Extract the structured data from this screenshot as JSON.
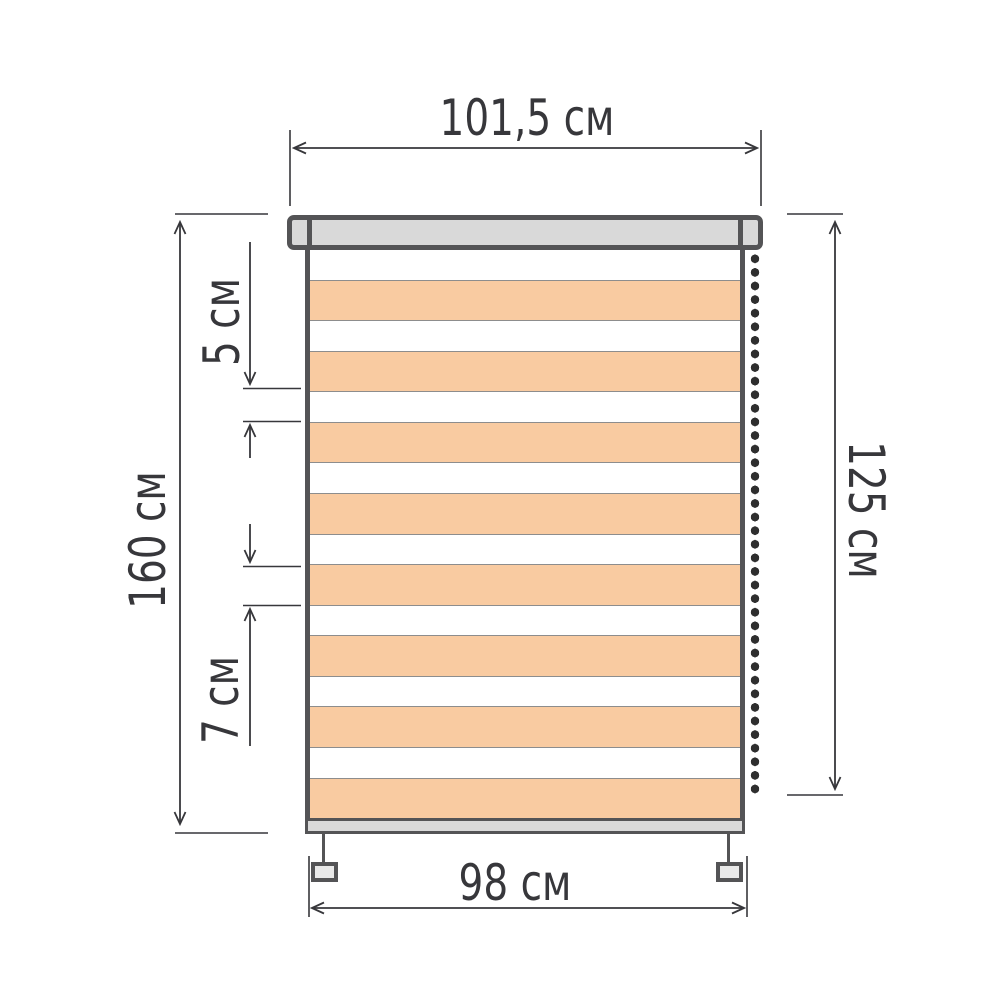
{
  "diagram": {
    "type": "dimension-drawing",
    "dimensions": {
      "cassette_width": {
        "label": "101,5 см",
        "value_cm": 101.5
      },
      "fabric_width": {
        "label": "98 см",
        "value_cm": 98
      },
      "total_height": {
        "label": "160 см",
        "value_cm": 160
      },
      "drop_height": {
        "label": "125 см",
        "value_cm": 125
      },
      "gap_stripe": {
        "label": "5 см",
        "value_cm": 5
      },
      "solid_stripe": {
        "label": "7 см",
        "value_cm": 7
      }
    },
    "colors": {
      "ink": "#37373b",
      "outline": "#545456",
      "cassette_fill": "#d9d9d9",
      "stripe_fill": "#f9cba1",
      "stripe_gap_fill": "#ffffff",
      "separator": "#8d8d8d",
      "chain_bead": "#2e2e2e",
      "bracket_fill": "#e9e9e9"
    },
    "structure": {
      "stripe_pairs": 8,
      "chain_side": "right",
      "bracket_count": 2
    }
  }
}
